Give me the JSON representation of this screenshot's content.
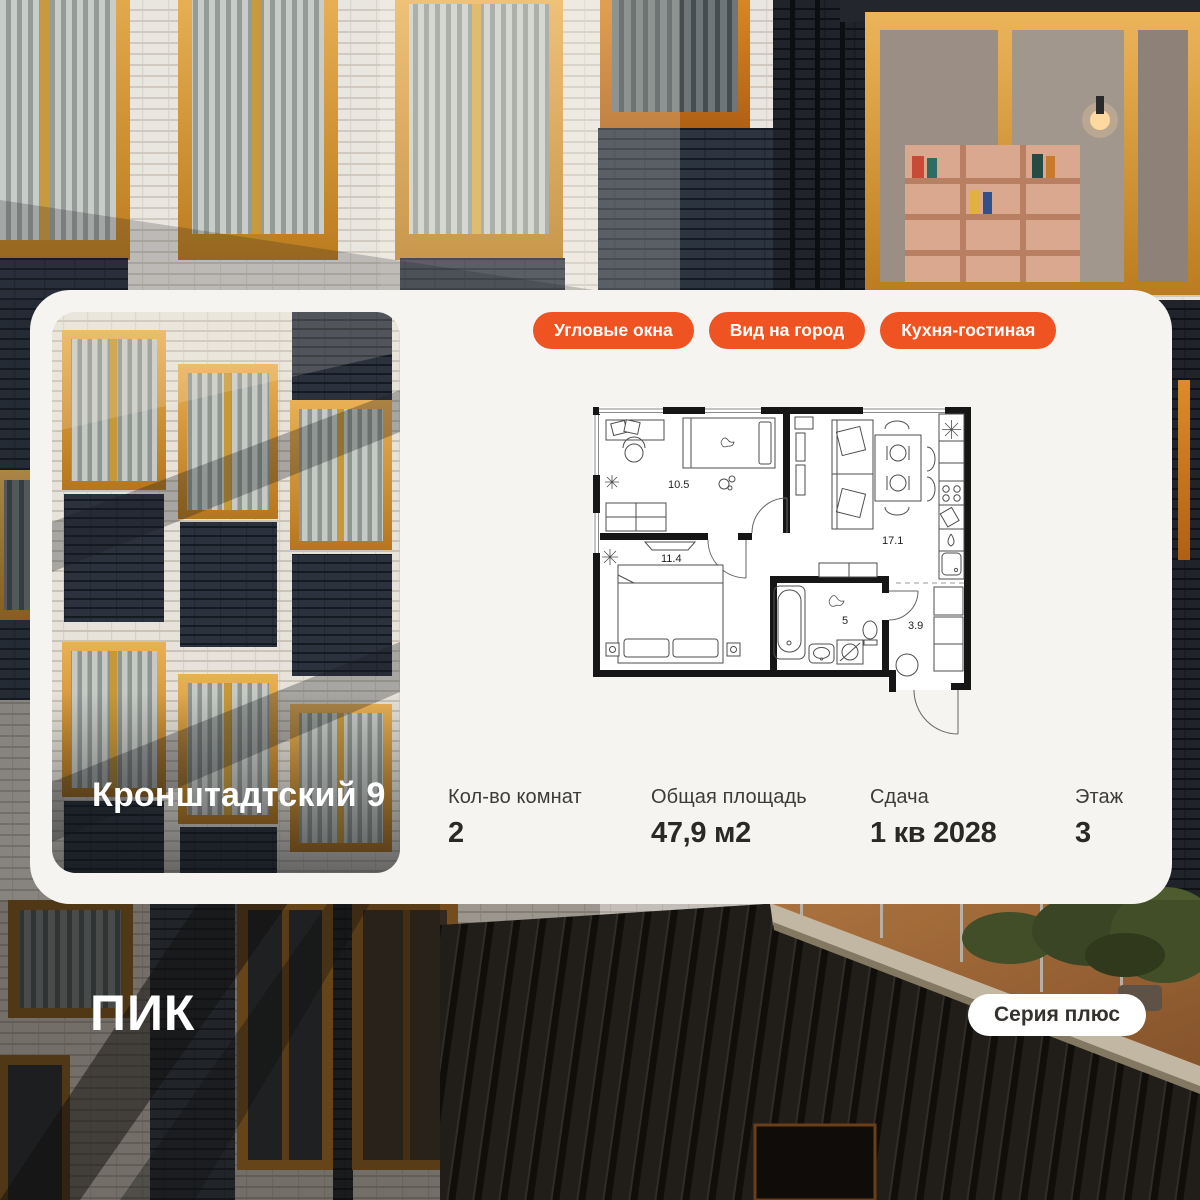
{
  "card": {
    "project_title": "Кронштадтский 9",
    "badges": [
      {
        "label": "Угловые окна"
      },
      {
        "label": "Вид на город"
      },
      {
        "label": "Кухня-гостиная"
      }
    ],
    "floor_plan": {
      "rooms": [
        {
          "name": "bedroom-1",
          "area": "10.5"
        },
        {
          "name": "bedroom-2",
          "area": "11.4"
        },
        {
          "name": "kitchen-living",
          "area": "17.1"
        },
        {
          "name": "bathroom",
          "area": "5"
        },
        {
          "name": "hallway",
          "area": "3.9"
        }
      ]
    },
    "stats": [
      {
        "label": "Кол-во комнат",
        "value": "2"
      },
      {
        "label": "Общая площадь",
        "value": "47,9 м2"
      },
      {
        "label": "Сдача",
        "value": "1 кв 2028"
      },
      {
        "label": "Этаж",
        "value": "3"
      }
    ]
  },
  "footer": {
    "logo": "ПИК",
    "series_label": "Серия плюс"
  },
  "colors": {
    "accent_orange": "#EF5322",
    "card_background": "#F5F4F1"
  }
}
